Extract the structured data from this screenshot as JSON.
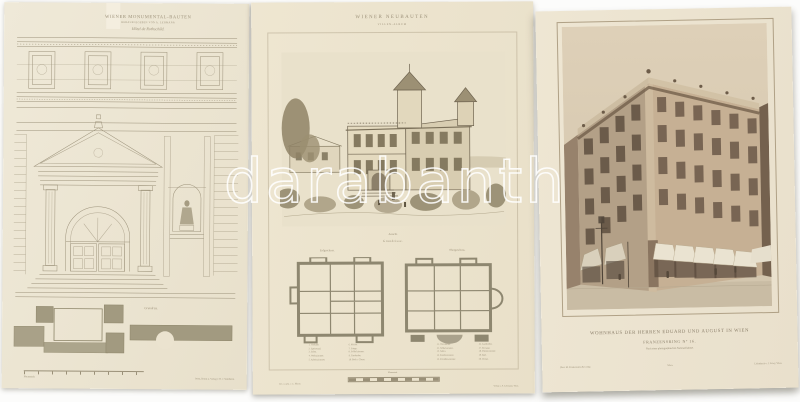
{
  "watermark": "darabanth",
  "palette": {
    "background": "#fcfcfb",
    "paper": "#ece4d0",
    "print_ink": "#9c9179",
    "photo_sepia_wall": "#c6b094",
    "photo_sepia_shadow": "#6e5b47",
    "plan_olive": "#a29a80",
    "watermark_outline": "#ffffff"
  },
  "left_print": {
    "title": "WIENER MONUMENTAL-BAUTEN",
    "subtitle": "HERAUSGEGEBEN VON A. LEHMANN",
    "plate_name": "Hôtel de Rothschild.",
    "plan_label": "Grundriss.",
    "scale_label": "Maassstab.",
    "imprint": "Wien, Druck u. Verlag v. R. v. Waldheim."
  },
  "middle_print": {
    "title": "WIENER NEUBAUTEN",
    "subtitle": "VILLEN-ALBUM",
    "view_caption": "Ansicht.",
    "plans_caption": "Grundrisse.",
    "plan_left_label": "Erdgeschoss.",
    "plan_right_label": "Obergeschoss.",
    "legend_left_col1": [
      "1. Vorhalle.",
      "2. Speisesaal.",
      "3. Salon.",
      "4. Wohnzimmer.",
      "5. Arbeitszimmer."
    ],
    "legend_left_col2": [
      "6. Küche.",
      "7. Stiege.",
      "8. Schlafzimmer.",
      "9. Garderobe.",
      "10. Bad u. Closet."
    ],
    "legend_right_col1": [
      "11. Vorzimmer.",
      "12. Schlafzimmer.",
      "13. Salon.",
      "14. Kinderzimmer.",
      "15. Fremdenzimmer."
    ],
    "legend_right_col2": [
      "16. Garderobe.",
      "17. Terrasse.",
      "18. Dienerzimmer.",
      "19. Bad.",
      "20. Closet."
    ],
    "scale_label": "Maassstab.",
    "imprint_left": "Gez. u. gest. v. C. Mayer.",
    "imprint_right": "Verlag v. A. Lehmann, Wien."
  },
  "right_print": {
    "caption_line1": "WOHNHAUS DER HERREN EDUARD UND AUGUST IN WIEN",
    "caption_line2": "FRANZENSRING Nº 16.",
    "caption_line3": "Nach einer photographischen Naturaufnahme.",
    "imprint_left": "Phot. M. Frankenstein & Comp.",
    "imprint_center": "Wien.",
    "imprint_right": "Lichtdruck v. J. Löwy, Wien."
  }
}
